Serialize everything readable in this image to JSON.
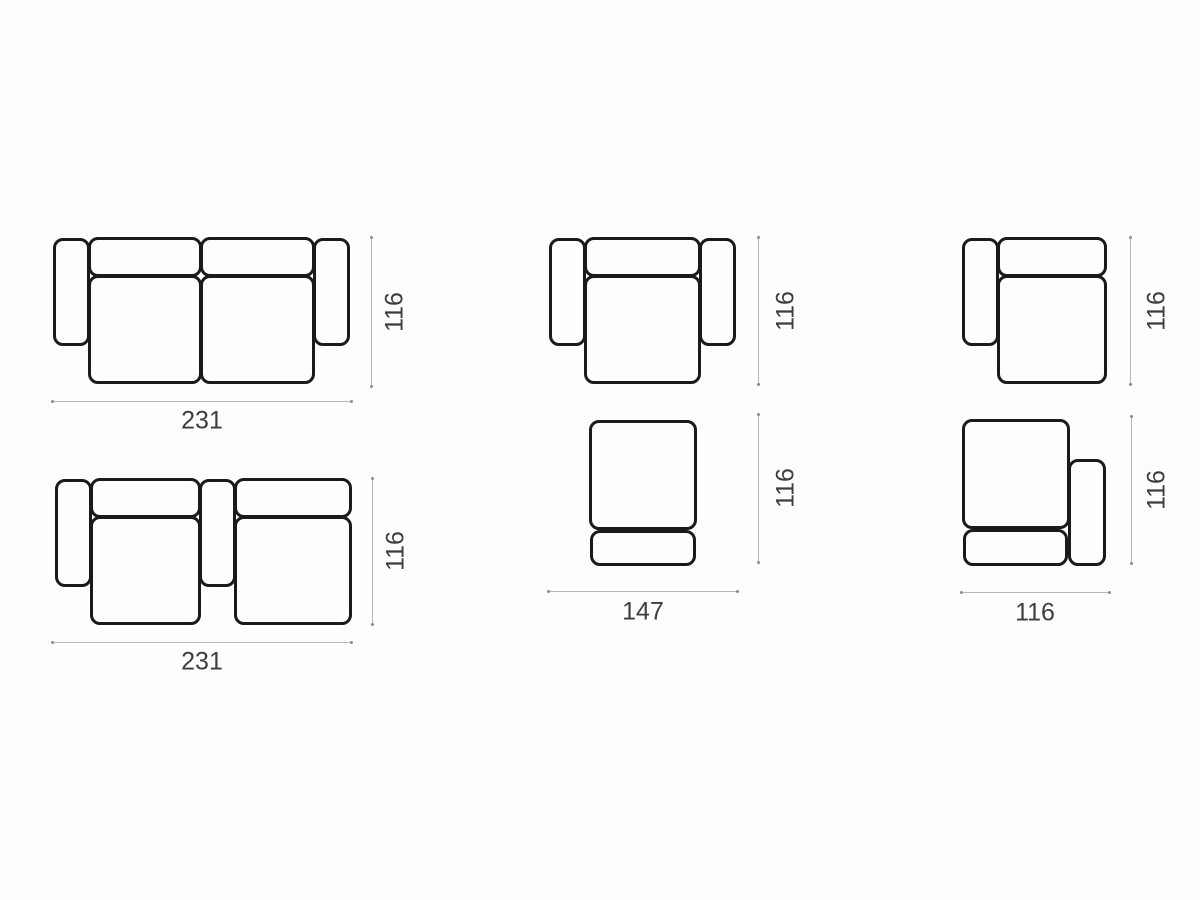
{
  "title": "Modular sofa configuration dimension diagrams (top view)",
  "colors": {
    "background": "#fdfdfd",
    "outline": "#1a1a1a",
    "dimension_line": "#b7b7b7",
    "dimension_endpoint": "#8d8d8d",
    "label_text": "#3d3d3d"
  },
  "columns": [
    {
      "position": "left",
      "diagrams": [
        {
          "id": "sofa-two-seat-both-arms",
          "description": "two-seat sofa with left and right armrests",
          "width": "231",
          "depth": "116"
        },
        {
          "id": "sofa-two-seat-center-arm",
          "description": "two-seat sofa with left and center armrests",
          "width": "231",
          "depth": "116"
        }
      ]
    },
    {
      "position": "middle",
      "width": "147",
      "diagrams": [
        {
          "id": "armchair-both-arms",
          "description": "armchair with two armrests",
          "depth": "116"
        },
        {
          "id": "module-armless",
          "description": "armless module",
          "depth": "116"
        }
      ]
    },
    {
      "position": "right",
      "width": "116",
      "diagrams": [
        {
          "id": "module-left-arm",
          "description": "module with left armrest",
          "depth": "116"
        },
        {
          "id": "module-right-arm",
          "description": "module with right armrest",
          "depth": "116"
        }
      ]
    }
  ]
}
